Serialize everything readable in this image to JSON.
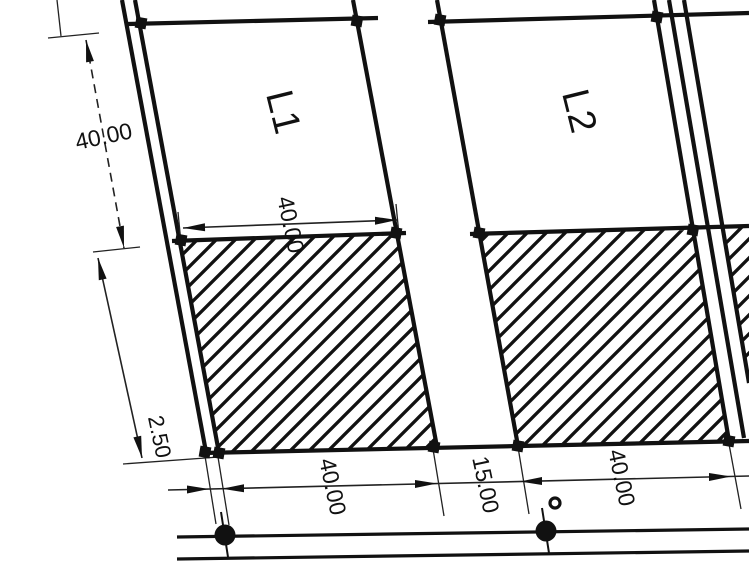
{
  "drawing": {
    "type": "cadastral-survey-plat",
    "lots": {
      "lot1_label": "L1",
      "lot2_label": "L2"
    },
    "dimensions": {
      "left_depth": "40.00",
      "lot1_width": "40.00",
      "strip_width": "2.50",
      "lot1_frontage": "40.00",
      "road_gap": "15.00",
      "lot2_frontage": "40.00"
    },
    "colors": {
      "ink": "#111111",
      "paper": "#ffffff"
    }
  }
}
